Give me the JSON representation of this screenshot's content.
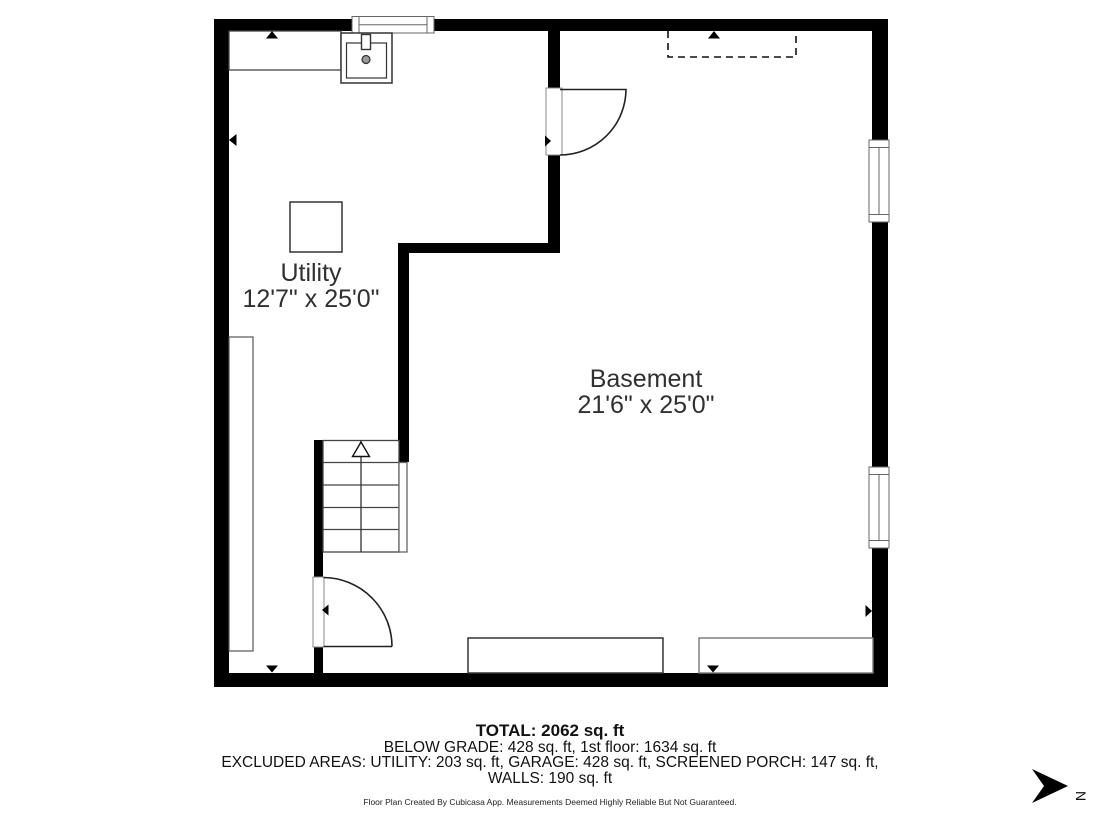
{
  "floorplan": {
    "rooms": [
      {
        "name": "Utility",
        "dimensions": "12'7\" x 25'0\""
      },
      {
        "name": "Basement",
        "dimensions": "21'6\" x 25'0\""
      }
    ],
    "compass_label": "N"
  },
  "summary": {
    "total": "TOTAL: 2062 sq. ft",
    "below_grade": "BELOW GRADE: 428 sq. ft, 1st floor: 1634 sq. ft",
    "excluded": "EXCLUDED AREAS: UTILITY: 203 sq. ft, GARAGE: 428 sq. ft, SCREENED PORCH: 147 sq. ft,",
    "walls": "WALLS: 190 sq. ft"
  },
  "footer": {
    "credit": "Floor Plan Created By Cubicasa App. Measurements Deemed Highly Reliable But Not Guaranteed."
  }
}
